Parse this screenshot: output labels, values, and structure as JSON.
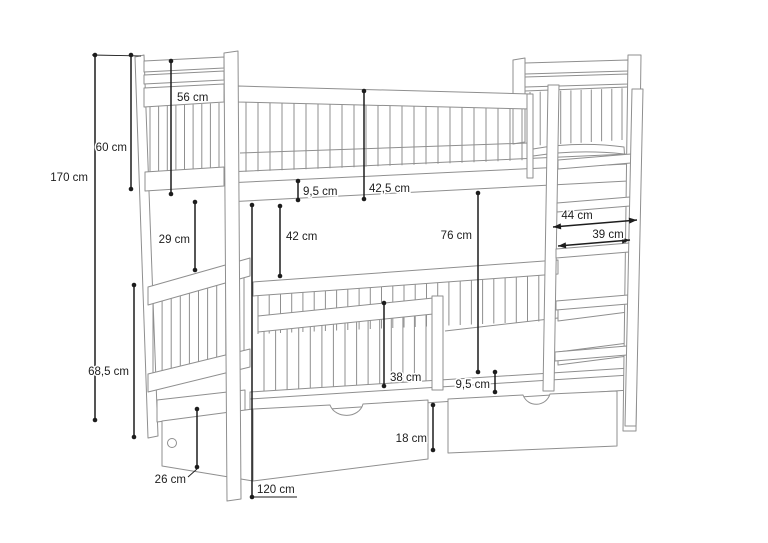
{
  "meta": {
    "drawing_type": "bunk-bed-technical-drawing",
    "units": "cm",
    "background_color": "#ffffff",
    "structure_line_color": "#8f8f8f",
    "dimension_color": "#1d1d1d"
  },
  "dimensions": [
    {
      "id": "overall-height",
      "label": "170 cm",
      "value": 170,
      "orientation": "vertical",
      "x1": 95,
      "y1": 55,
      "x2": 95,
      "y2": 420,
      "label_x": 88,
      "label_y": 181,
      "anchor": "end"
    },
    {
      "id": "upper-headboard-height",
      "label": "60 cm",
      "value": 60,
      "orientation": "vertical",
      "x1": 131,
      "y1": 55,
      "x2": 131,
      "y2": 189,
      "label_x": 127,
      "label_y": 151,
      "anchor": "end"
    },
    {
      "id": "upper-guardrail-height",
      "label": "56 cm",
      "value": 56,
      "orientation": "vertical",
      "x1": 171,
      "y1": 61,
      "x2": 171,
      "y2": 194,
      "label_x": 177,
      "label_y": 101,
      "anchor": "start"
    },
    {
      "id": "upper-frame-thickness",
      "label": "9,5 cm",
      "value": 9.5,
      "orientation": "vertical",
      "x1": 298,
      "y1": 181,
      "x2": 298,
      "y2": 200,
      "label_x": 303,
      "label_y": 195,
      "anchor": "start"
    },
    {
      "id": "upper-rail-to-frame",
      "label": "42,5 cm",
      "value": 42.5,
      "orientation": "vertical",
      "x1": 364,
      "y1": 91,
      "x2": 364,
      "y2": 199,
      "label_x": 369,
      "label_y": 192,
      "anchor": "start"
    },
    {
      "id": "headboard-gap",
      "label": "29 cm",
      "value": 29,
      "orientation": "vertical",
      "x1": 195,
      "y1": 202,
      "x2": 195,
      "y2": 270,
      "label_x": 190,
      "label_y": 243,
      "anchor": "end"
    },
    {
      "id": "bunk-clearance-left",
      "label": "42 cm",
      "value": 42,
      "orientation": "vertical",
      "x1": 280,
      "y1": 206,
      "x2": 280,
      "y2": 276,
      "label_x": 286,
      "label_y": 240,
      "anchor": "start"
    },
    {
      "id": "bunk-clearance",
      "label": "76 cm",
      "value": 76,
      "orientation": "vertical",
      "x1": 478,
      "y1": 193,
      "x2": 478,
      "y2": 372,
      "label_x": 472,
      "label_y": 239,
      "anchor": "end"
    },
    {
      "id": "ladder-width-outer",
      "label": "44 cm",
      "value": 44,
      "orientation": "horizontal",
      "x1": 553,
      "y1": 227,
      "x2": 637,
      "y2": 220,
      "label_x": 577,
      "label_y": 219,
      "anchor": "middle"
    },
    {
      "id": "ladder-width-inner",
      "label": "39 cm",
      "value": 39,
      "orientation": "horizontal",
      "x1": 558,
      "y1": 246,
      "x2": 630,
      "y2": 240,
      "label_x": 608,
      "label_y": 238,
      "anchor": "middle"
    },
    {
      "id": "lower-section-height",
      "label": "68,5 cm",
      "value": 68.5,
      "orientation": "vertical",
      "x1": 134,
      "y1": 285,
      "x2": 134,
      "y2": 437,
      "label_x": 129,
      "label_y": 375,
      "anchor": "end"
    },
    {
      "id": "lower-guardrail-height",
      "label": "38 cm",
      "value": 38,
      "orientation": "vertical",
      "x1": 384,
      "y1": 303,
      "x2": 384,
      "y2": 386,
      "label_x": 390,
      "label_y": 381,
      "anchor": "start"
    },
    {
      "id": "lower-frame-thickness",
      "label": "9,5 cm",
      "value": 9.5,
      "orientation": "vertical",
      "x1": 495,
      "y1": 372,
      "x2": 495,
      "y2": 392,
      "label_x": 490,
      "label_y": 388,
      "anchor": "end"
    },
    {
      "id": "drawer-height",
      "label": "18 cm",
      "value": 18,
      "orientation": "vertical",
      "x1": 433,
      "y1": 405,
      "x2": 433,
      "y2": 450,
      "label_x": 427,
      "label_y": 442,
      "anchor": "end"
    },
    {
      "id": "floor-clearance",
      "label": "26 cm",
      "value": 26,
      "orientation": "vertical",
      "x1": 197,
      "y1": 409,
      "x2": 197,
      "y2": 467,
      "label_x": 186,
      "label_y": 483,
      "anchor": "end",
      "leader": [
        [
          188,
          477
        ],
        [
          197,
          469
        ]
      ]
    },
    {
      "id": "floor-to-upper-frame",
      "label": "120 cm",
      "value": 120,
      "orientation": "vertical",
      "x1": 252,
      "y1": 205,
      "x2": 252,
      "y2": 497,
      "label_x": 257,
      "label_y": 493,
      "anchor": "start",
      "leader": [
        [
          252,
          497
        ],
        [
          297,
          497
        ]
      ]
    }
  ],
  "extension_lines": [
    {
      "id": "top-extension",
      "points": [
        [
          92,
          55
        ],
        [
          141,
          56
        ]
      ]
    }
  ]
}
